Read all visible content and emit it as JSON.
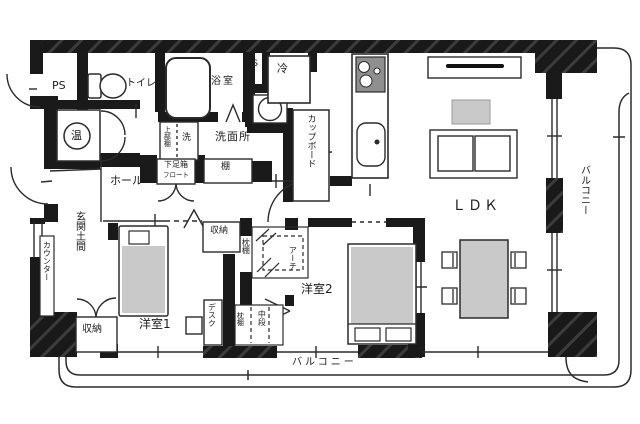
{
  "colors": {
    "wall": "#1a1a1a",
    "line": "#2b2b2b",
    "furniture": "#c9c9c9",
    "stove": "#8f8f8f"
  },
  "labels": {
    "ps_left": "PS",
    "toilet": "トイレ",
    "bath": "浴室",
    "ps_kitchen": "PS",
    "fridge": "冷",
    "cupboard": "カップボード",
    "washroom": "洗面所",
    "washer": "洗",
    "upper_shelf": "上部棚",
    "water_heater": "温",
    "shoe_box_line1": "下足箱",
    "shoe_box_line2": "フロート",
    "shelf": "棚",
    "hall": "ホール",
    "entrance": "玄関土間",
    "counter": "カウンター",
    "storage_entrance": "収納",
    "bedroom1": "洋室1",
    "desk": "デスク",
    "storage_hall": "収納",
    "pillow_shelf_upper": "枕棚",
    "arch": "アーチ",
    "bedroom2": "洋室2",
    "pillow_shelf_lower": "枕棚",
    "middle_shelf": "中段",
    "ldk": "ＬＤＫ",
    "balcony_right": "バルコニー",
    "balcony_bottom": "バルコニー"
  }
}
